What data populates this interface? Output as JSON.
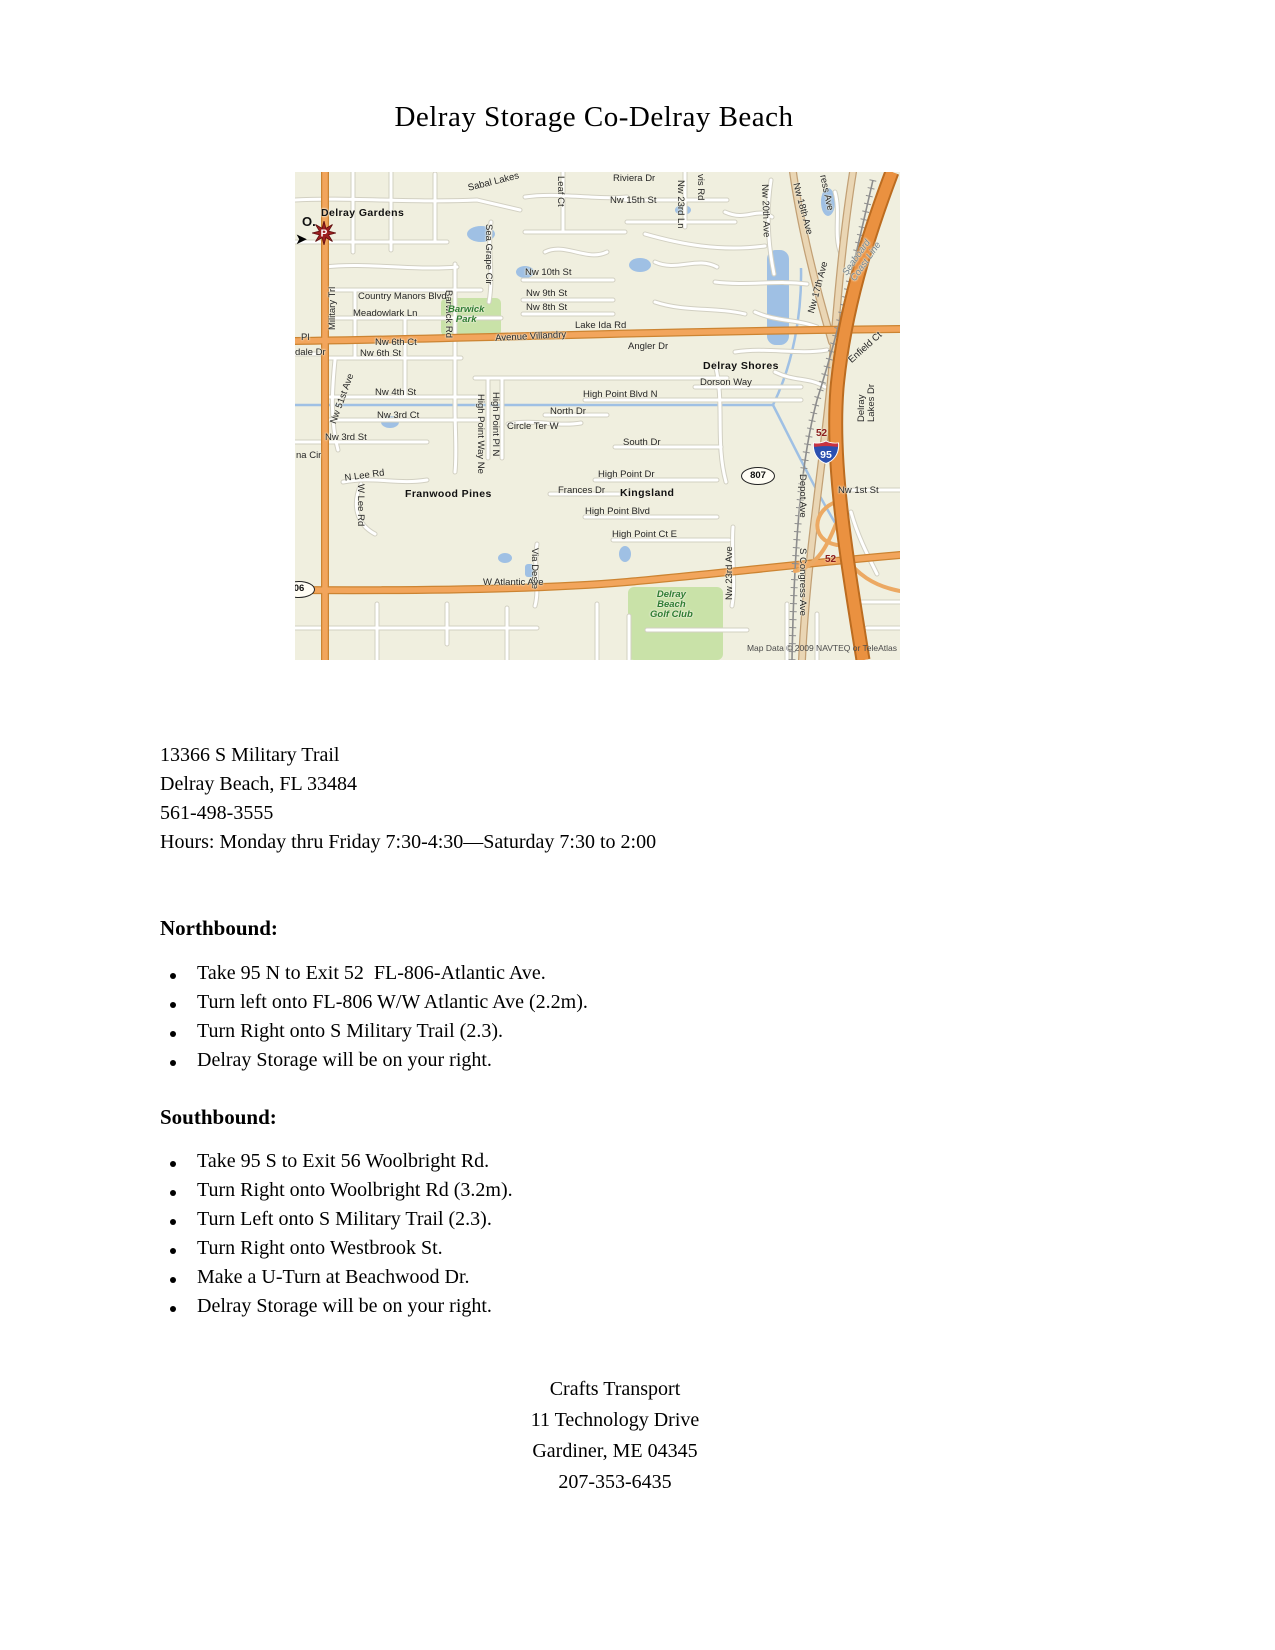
{
  "page": {
    "title": "Delray Storage Co-Delray Beach"
  },
  "map": {
    "labels": [
      "Delray Gardens",
      "Sabal Lakes",
      "Leaf Ct",
      "Riviera Dr",
      "Nw 15th St",
      "Nw 23rd Ln",
      "vis Rd",
      "Nw 20th Ave",
      "Nw 18th Ave",
      "ress Ave",
      "Seaboard Coast Line",
      "Nw 17th Ave",
      "Sea Grape Cir",
      "Barwick Rd",
      "Nw 10th St",
      "Country Manors Blvd",
      "Nw 9th St",
      "Nw 8th St",
      "Meadowlark Ln",
      "Barwick\nPark",
      "Lake Ida Rd",
      "Pl",
      "dale Dr",
      "Nw 6th Ct",
      "Avenue Villandry",
      "Angler Dr",
      "Nw 6th St",
      "Enfield Ct",
      "Delray Shores",
      "Dorson Way",
      "Delray Lakes Dr",
      "Military Trl",
      "Nw 4th St",
      "High Point Blvd N",
      "North Dr",
      "Nw 3rd Ct",
      "High Point Way Ne",
      "High Point Pl N",
      "Circle Ter W",
      "Nw 3rd St",
      "South Dr",
      "na Cir",
      "N Lee Rd",
      "W Lee Rd",
      "High Point Dr",
      "Frances Dr",
      "Kingsland",
      "Franwood Pines",
      "High Point Blvd",
      "High Point Ct E",
      "Via Deste",
      "Nw 23rd Ave",
      "Depot Ave",
      "Nw 1st St",
      "S Congress Ave",
      "Delray\nBeach\nGolf Club",
      "W Atlantic Ave",
      "Nw 51st Ave"
    ],
    "marker": {
      "p": "P",
      "o": "O."
    },
    "shields": {
      "i95": "95",
      "exit_top": "52",
      "exit_bottom": "52",
      "fl807": "807",
      "fl806": "06"
    },
    "copyright": "Map Data © 2009 NAVTEQ or TeleAtlas"
  },
  "address": {
    "lines": [
      "13366 S Military Trail",
      "Delray Beach, FL 33484",
      "561-498-3555",
      "Hours: Monday thru Friday 7:30-4:30—Saturday 7:30 to 2:00"
    ]
  },
  "northbound": {
    "heading": "Northbound:",
    "items": [
      "Take 95 N to Exit 52  FL-806-Atlantic Ave.",
      "Turn left onto FL-806 W/W Atlantic Ave (2.2m).",
      "Turn Right onto S Military Trail (2.3).",
      "Delray Storage will be on your right."
    ]
  },
  "southbound": {
    "heading": "Southbound:",
    "items": [
      "Take 95 S to Exit 56 Woolbright Rd.",
      "Turn Right onto Woolbright Rd (3.2m).",
      "Turn Left onto S Military Trail (2.3).",
      "Turn Right onto Westbrook St.",
      "Make a U-Turn at Beachwood Dr.",
      "Delray Storage will be on your right."
    ]
  },
  "footer": {
    "lines": [
      "Crafts Transport",
      "11 Technology Drive",
      "Gardiner, ME 04345",
      "207-353-6435"
    ]
  }
}
